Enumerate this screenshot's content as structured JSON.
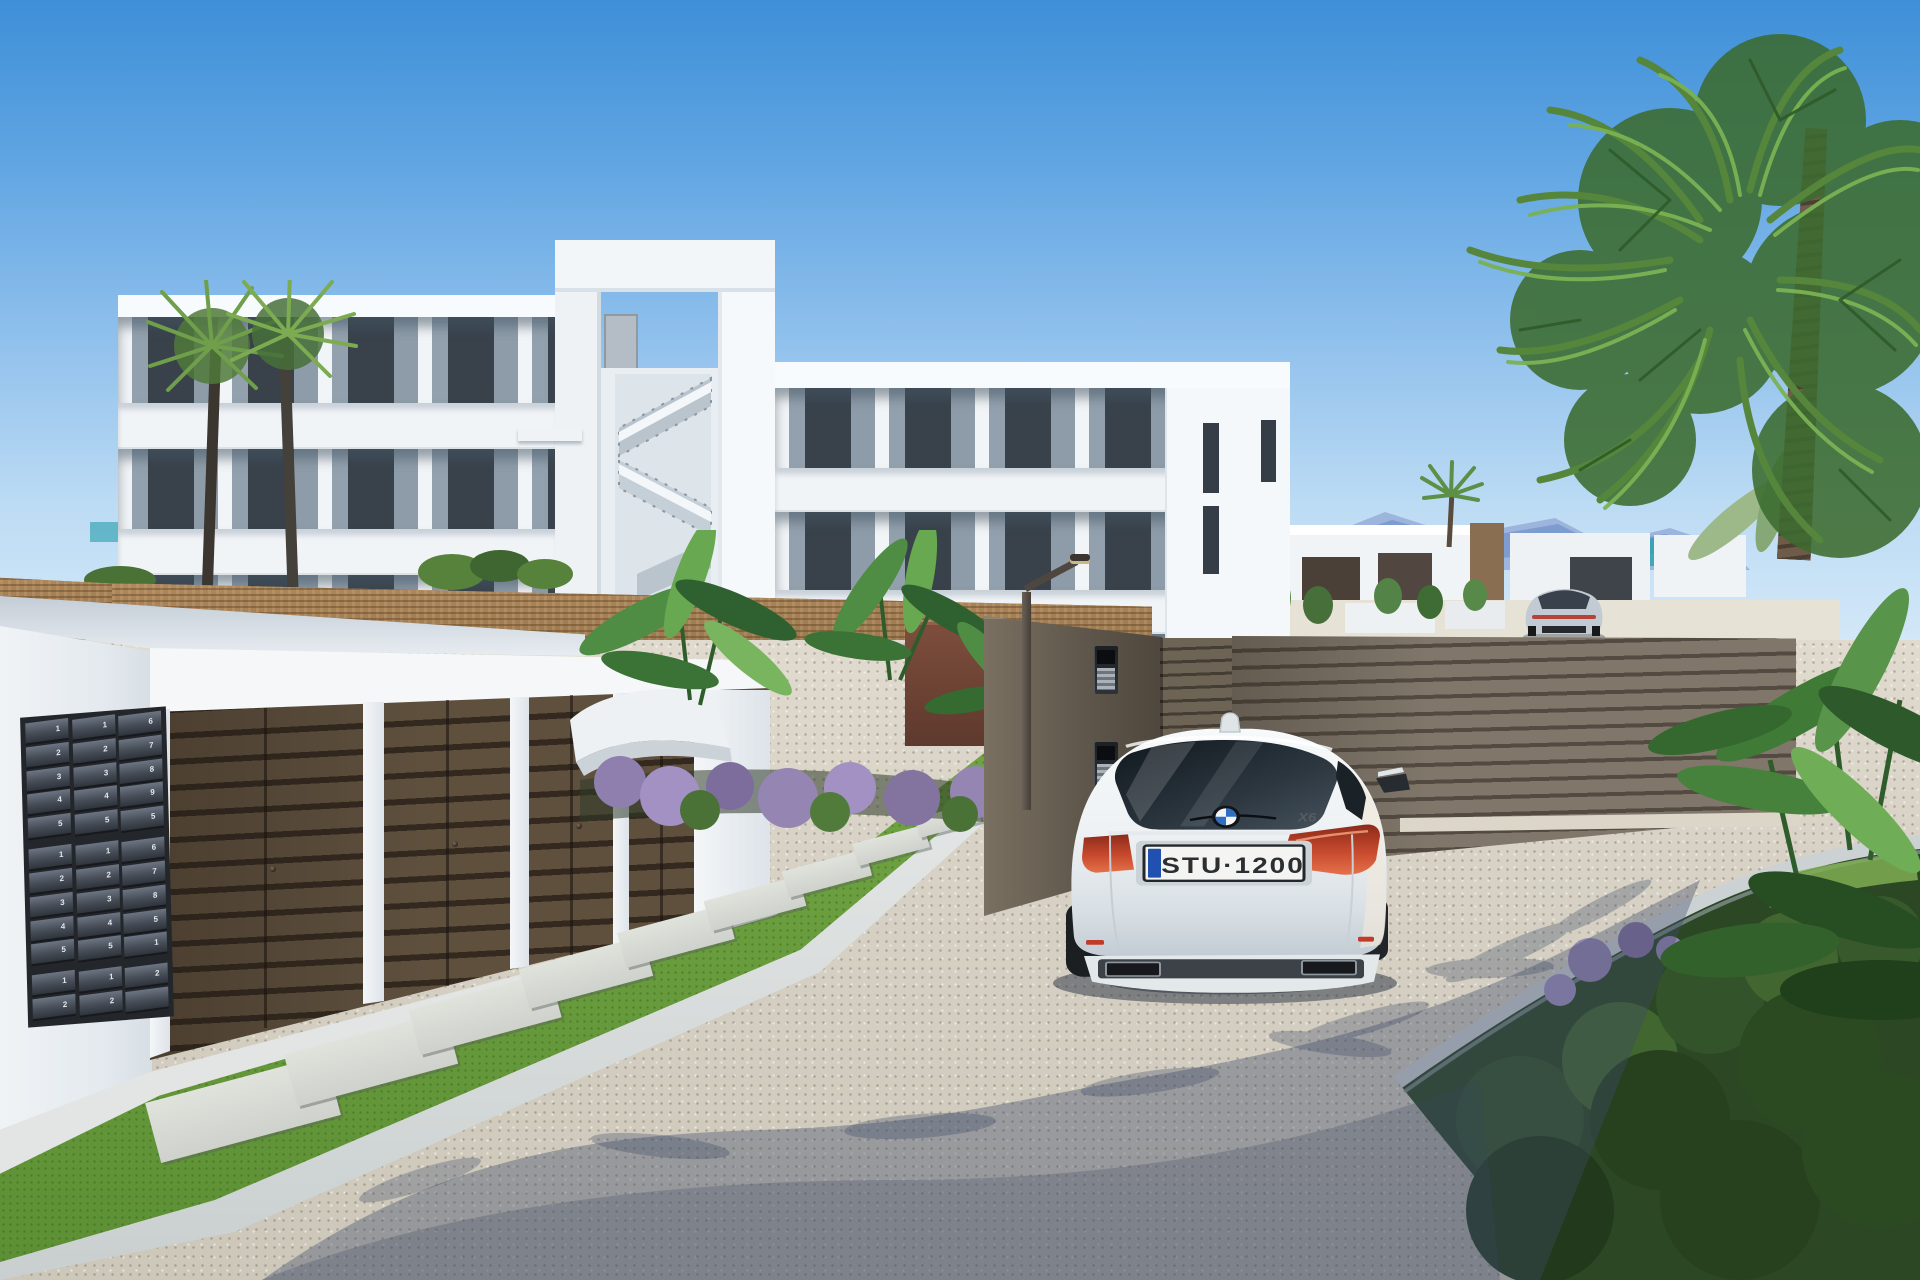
{
  "scene": {
    "description_colors": {
      "sky_top": "#3e8fd8",
      "sky_horizon": "#dcedf9",
      "mountains": "#7d9ccf",
      "sea": "#2fa2b0",
      "building_white": "#f4f6f8",
      "building_shadow": "#93a1ae",
      "glass": "#39424b",
      "cane_fence": "#a8835b",
      "gate_slat": "#80766a",
      "gate_gap": "#534b41",
      "gate_wall": "#5f574b",
      "garage_door": "#5f503e",
      "garage_door_gap": "#33291f",
      "garage_pillar": "#f4f6f8",
      "mailbox_panel": "#23262b",
      "mailbox_flap": "#464d57",
      "gravel_sunlit": "#d8d3c6",
      "gravel_shadow": "#3d4a66",
      "grass": "#74a845",
      "stepping_stone": "#e0e2dc",
      "curb": "#eceeed",
      "palm_green": "#69a24c",
      "palm_trunk": "#6e5b49",
      "banana_green": "#4f8c44",
      "lavender": "#9585b3",
      "bush_dark": "#2c4724",
      "red_brown_pillar": "#7e4e3d",
      "lamp_post": "#4e4740"
    }
  },
  "cars": {
    "foreground": {
      "license_plate": "STU·1200",
      "model_badge": "X6",
      "brand_icon": "bmw-roundel-icon",
      "body_color": "#f2f4f6",
      "taillight_color": "#c8492e",
      "plate_band_color": "#2050b0"
    },
    "background": {
      "body_color": "#c2cbd3"
    }
  },
  "mailboxes": {
    "section_breaks": [
      5,
      10
    ],
    "columns": [
      [
        "1",
        "2",
        "3",
        "4",
        "5",
        "1",
        "2",
        "3",
        "4",
        "5",
        "1",
        "2"
      ],
      [
        "1",
        "2",
        "3",
        "4",
        "5",
        "1",
        "2",
        "3",
        "4",
        "5",
        "1",
        "2"
      ],
      [
        "6",
        "7",
        "8",
        "9",
        "5",
        "6",
        "7",
        "8",
        "5",
        "1",
        "2",
        ""
      ]
    ]
  },
  "intercom": {
    "units": 2
  }
}
